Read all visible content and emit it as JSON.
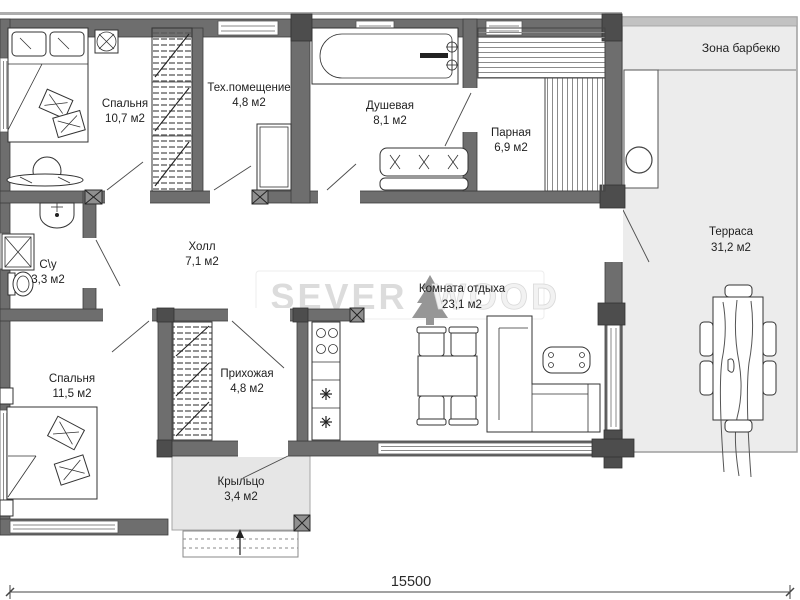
{
  "plan": {
    "rooms": [
      {
        "id": "bedroom-1",
        "name": "Спальня",
        "area": "10,7 м2"
      },
      {
        "id": "tech-room",
        "name": "Тех.помещение",
        "area": "4,8 м2"
      },
      {
        "id": "shower-room",
        "name": "Душевая",
        "area": "8,1 м2"
      },
      {
        "id": "steam-room",
        "name": "Парная",
        "area": "6,9 м2"
      },
      {
        "id": "hall",
        "name": "Холл",
        "area": "7,1 м2"
      },
      {
        "id": "bathroom",
        "name": "С\\у",
        "area": "3,3 м2"
      },
      {
        "id": "lounge",
        "name": "Комната отдыха",
        "area": "23,1 м2"
      },
      {
        "id": "bedroom-2",
        "name": "Спальня",
        "area": "11,5 м2"
      },
      {
        "id": "entry-hall",
        "name": "Прихожая",
        "area": "4,8 м2"
      },
      {
        "id": "porch",
        "name": "Крыльцо",
        "area": "3,4 м2"
      },
      {
        "id": "terrace",
        "name": "Терраса",
        "area": "31,2 м2"
      },
      {
        "id": "bbq-zone",
        "name": "Зона барбекю",
        "area": ""
      }
    ],
    "dimension_label": "15500",
    "watermark": {
      "left": "SEVER",
      "right": "WOOD"
    },
    "colors": {
      "wall": "#6e6e6e",
      "terrace_fill": "#ececec",
      "porch_fill": "#e6e6e6",
      "watermark": "#dcdcdc"
    }
  }
}
